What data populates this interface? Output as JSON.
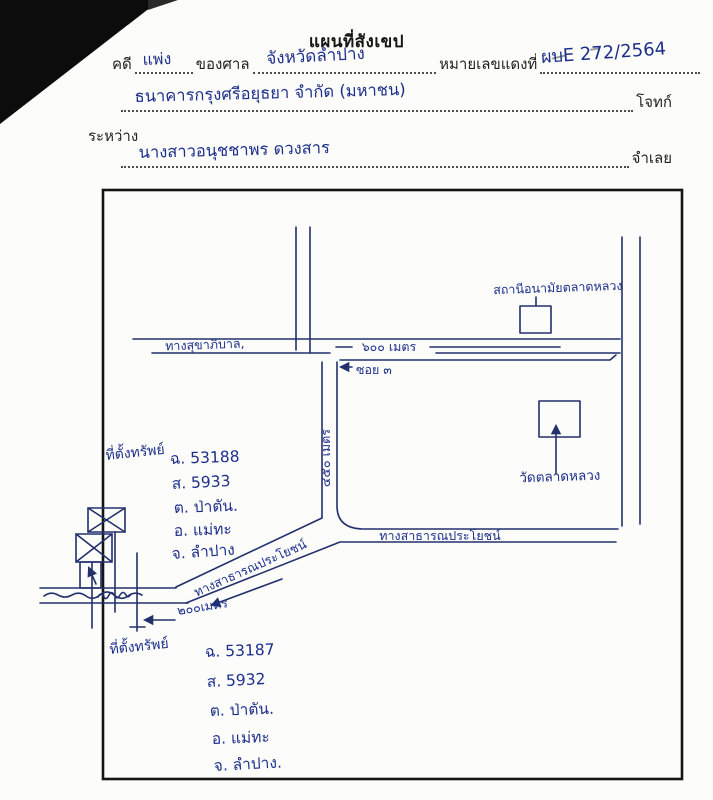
{
  "form": {
    "title": "แผนที่สังเขป",
    "case_label": "คดี",
    "case_value": "แพ่ง",
    "court_label": "ของศาล",
    "court_value": "จังหวัดลำปาง",
    "red_no_label": "หมายเลขแดงที่",
    "red_no_value": "ผบE 272/2564",
    "plaintiff_value": "ธนาคารกรุงศรีอยุธยา จำกัด (มหาชน)",
    "plaintiff_label": "โจทก์",
    "between_label": "ระหว่าง",
    "defendant_value": "นางสาวอนุชชาพร ดวงสาร",
    "defendant_label": "จำเลย"
  },
  "map": {
    "labels": {
      "road_top": "ทางสุขาภิบาล,",
      "dist_600": "๖๐๐ เมตร",
      "soi": "ซอย ๓",
      "dist_450": "๔๕๐ เมตร",
      "health_station": "สถานีอนามัยตลาดหลวง",
      "temple": "วัดตลาดหลวง",
      "road_right": "ทางสาธารณประโยชน์",
      "road_diagonal": "ทางสาธารณประโยชน์",
      "dist_200": "๒๐๐เมตร"
    },
    "property_1": {
      "title": "ที่ตั้งทรัพย์",
      "deed": "ฉ. 53188",
      "survey": "ส. 5933",
      "tambon": "ต. ป่าตัน.",
      "amphoe": "อ. แม่ทะ",
      "province": "จ. ลำปาง"
    },
    "property_2": {
      "title": "ที่ตั้งทรัพย์",
      "deed": "ฉ. 53187",
      "survey": "ส. 5932",
      "tambon": "ต. ป่าตัน.",
      "amphoe": "อ. แม่ทะ",
      "province": "จ. ลำปาง."
    }
  },
  "colors": {
    "ink_blue": "#1c2f8c",
    "ink_black": "#141414"
  }
}
